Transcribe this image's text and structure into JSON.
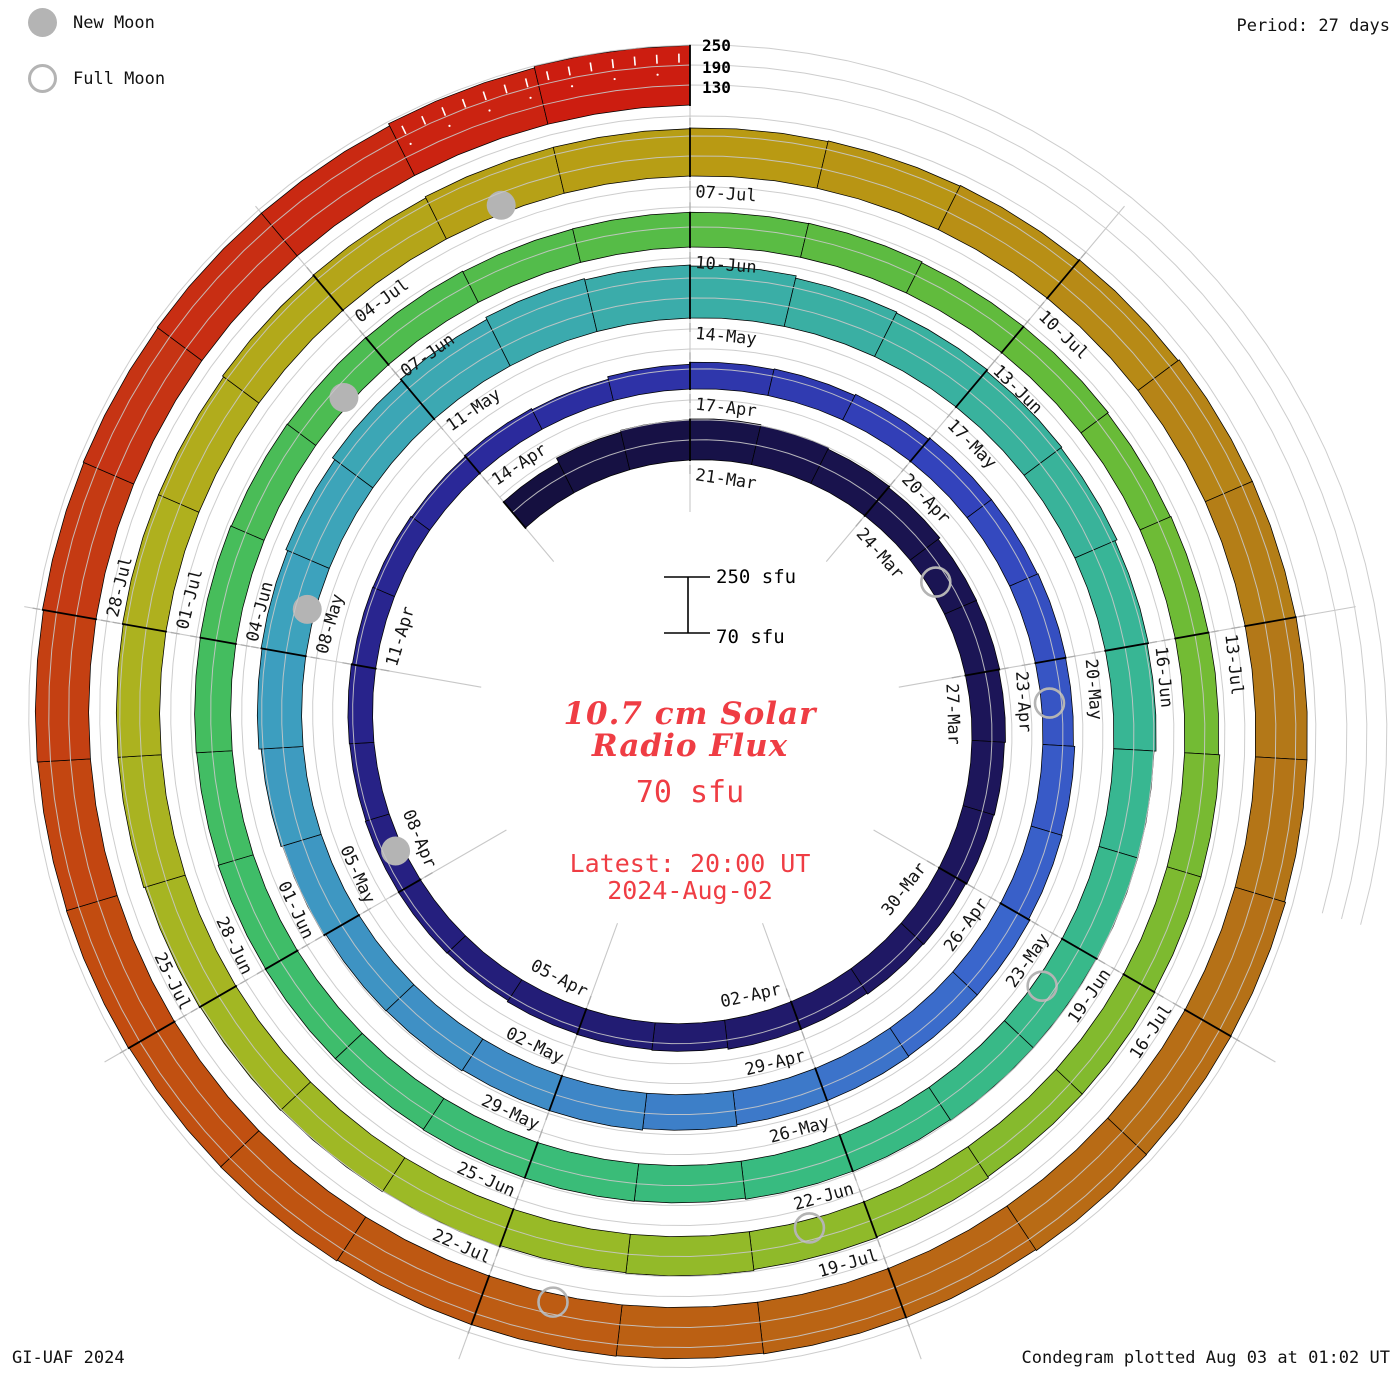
{
  "legend": {
    "new_moon_label": "New Moon",
    "full_moon_label": "Full Moon"
  },
  "header": {
    "period_note": "Period: 27 days"
  },
  "footer": {
    "credit": "GI-UAF 2024",
    "plotted_note": "Condegram plotted Aug 03 at 01:02 UT"
  },
  "center": {
    "title_line1": "10.7 cm Solar",
    "title_line2": "Radio Flux",
    "current_value": "70 sfu",
    "latest_time": "Latest: 20:00 UT",
    "latest_date": "2024-Aug-02",
    "scale_top_label": "250 sfu",
    "scale_bottom_label": "70 sfu"
  },
  "radial_axis": {
    "tick_labels": [
      "250",
      "190",
      "130"
    ]
  },
  "chart_data": {
    "type": "spiral-bar",
    "description": "Condegram: daily 10.7 cm solar radio flux on a clockwise spiral, one turn per 27-day solar rotation; bar height is flux above the 70 sfu baseline; color encodes date from dark navy (March) to red (August).",
    "title": "10.7 cm Solar Radio Flux",
    "units": "sfu",
    "period_days": 27,
    "baseline_sfu": 70,
    "scale_max_sfu": 250,
    "grid_levels_sfu": [
      130,
      190,
      250
    ],
    "start_date": "2024-03-18",
    "end_date": "2024-08-02",
    "angle_zero_label": "21-Mar",
    "first_label_day_index": 3,
    "label_step_days": 3,
    "date_labels": [
      "21-Mar",
      "24-Mar",
      "27-Mar",
      "30-Mar",
      "02-Apr",
      "05-Apr",
      "08-Apr",
      "11-Apr",
      "14-Apr",
      "17-Apr",
      "20-Apr",
      "23-Apr",
      "26-Apr",
      "29-Apr",
      "02-May",
      "05-May",
      "08-May",
      "11-May",
      "14-May",
      "17-May",
      "20-May",
      "23-May",
      "26-May",
      "29-May",
      "01-Jun",
      "04-Jun",
      "07-Jun",
      "10-Jun",
      "13-Jun",
      "16-Jun",
      "19-Jun",
      "22-Jun",
      "25-Jun",
      "28-Jun",
      "01-Jul",
      "04-Jul",
      "07-Jul",
      "10-Jul",
      "13-Jul",
      "16-Jul",
      "19-Jul",
      "22-Jul",
      "25-Jul",
      "28-Jul"
    ],
    "values_sfu": [
      172,
      186,
      191,
      193,
      190,
      185,
      181,
      175,
      174,
      171,
      168,
      166,
      163,
      161,
      158,
      158,
      153,
      151,
      149,
      145,
      146,
      145,
      143,
      144,
      141,
      140,
      137,
      140,
      136,
      144,
      150,
      152,
      156,
      161,
      161,
      163,
      162,
      166,
      167,
      171,
      171,
      173,
      173,
      177,
      181,
      181,
      184,
      185,
      191,
      196,
      203,
      206,
      212,
      221,
      226,
      233,
      229,
      226,
      219,
      216,
      211,
      208,
      201,
      197,
      191,
      191,
      189,
      189,
      186,
      185,
      182,
      183,
      183,
      181,
      181,
      180,
      177,
      178,
      179,
      177,
      176,
      175,
      173,
      174,
      174,
      175,
      172,
      172,
      169,
      171,
      172,
      176,
      176,
      178,
      178,
      182,
      184,
      188,
      186,
      190,
      192,
      194,
      196,
      200,
      200,
      202,
      202,
      206,
      208,
      212,
      212,
      214,
      216,
      218,
      220,
      224,
      224,
      225,
      225,
      228,
      229,
      230,
      227,
      226,
      224,
      225,
      225,
      228,
      227,
      229,
      228,
      230,
      233,
      235,
      237,
      237,
      244,
      249
    ],
    "moon_events": [
      {
        "type": "full",
        "date": "25-Mar",
        "day_index": 7
      },
      {
        "type": "new",
        "date": "08-Apr",
        "day_index": 21
      },
      {
        "type": "full",
        "date": "23-Apr",
        "day_index": 36
      },
      {
        "type": "new",
        "date": "08-May",
        "day_index": 51
      },
      {
        "type": "full",
        "date": "23-May",
        "day_index": 66
      },
      {
        "type": "new",
        "date": "06-Jun",
        "day_index": 80
      },
      {
        "type": "full",
        "date": "22-Jun",
        "day_index": 96
      },
      {
        "type": "new",
        "date": "05-Jul",
        "day_index": 109
      },
      {
        "type": "full",
        "date": "21-Jul",
        "day_index": 125
      }
    ],
    "colors": {
      "accent_red_text": "#ef3d44",
      "moon_gray": "#b4b4b4",
      "grid_gray": "#c8c8c8",
      "label_text": "#141414",
      "colormap_stops": [
        [
          0,
          "#151040"
        ],
        [
          12,
          "#1e1760"
        ],
        [
          21,
          "#262082"
        ],
        [
          27,
          "#2b2a9c"
        ],
        [
          33,
          "#3343bc"
        ],
        [
          39,
          "#3a66cc"
        ],
        [
          45,
          "#3f8cc6"
        ],
        [
          51,
          "#3da2bd"
        ],
        [
          57,
          "#3aaea6"
        ],
        [
          63,
          "#38b694"
        ],
        [
          69,
          "#38bb80"
        ],
        [
          75,
          "#3fbd68"
        ],
        [
          81,
          "#4fbc4e"
        ],
        [
          87,
          "#64bb3a"
        ],
        [
          93,
          "#82ba2e"
        ],
        [
          99,
          "#9cba26"
        ],
        [
          105,
          "#afb01e"
        ],
        [
          111,
          "#b99a13"
        ],
        [
          114,
          "#b78a16"
        ],
        [
          117,
          "#b37818"
        ],
        [
          123,
          "#ba6414"
        ],
        [
          129,
          "#c24c10"
        ],
        [
          133,
          "#c63414"
        ],
        [
          137,
          "#cc1d10"
        ]
      ]
    }
  }
}
